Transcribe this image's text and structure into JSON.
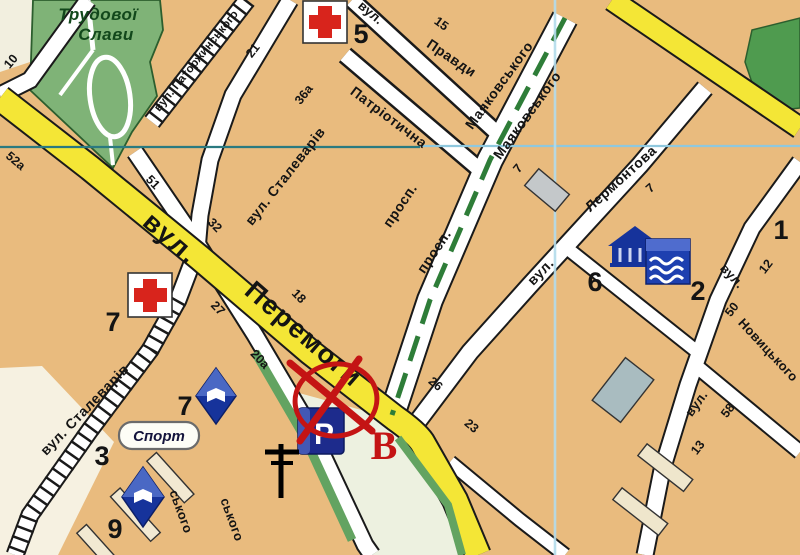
{
  "park": {
    "line1": "Трудової",
    "line2": "Слави"
  },
  "streets": {
    "peremohy_prefix": "вул.",
    "peremohy": "Перемоги",
    "stalevariv_upper": "вул. Сталеварів",
    "stalevariv_lower": "вул. Сталеварів",
    "patorzhynskoho": "вул. Паторжинського",
    "patriotychna": "Патріотична",
    "pravdy_prefix": "вул.",
    "pravdy": "Правди",
    "prospect_a": "просп.",
    "mayakovskoho_a": "Маяковського",
    "prospect_b": "просп.",
    "mayakovskoho_b": "Маяковського",
    "lermontova_prefix": "вул.",
    "lermontova": "Лермонтова",
    "novytskoho_prefix": "вул.",
    "novytskoho": "Новицького",
    "right_street_prefix": "вул.",
    "skoho_a": "ського",
    "skoho_b": "ського"
  },
  "house_numbers": {
    "n10": "10",
    "n52a": "52а",
    "n51": "51",
    "n21": "21",
    "n36a": "36а",
    "n32": "32",
    "n27": "27",
    "n18": "18",
    "n20a": "20а",
    "n15": "15",
    "n7_lerm_a": "7",
    "n7_lerm_b": "7",
    "n12": "12",
    "n50": "50",
    "n58": "58",
    "n13": "13",
    "n26": "26",
    "n23": "23"
  },
  "poi_numbers": {
    "n5": "5",
    "n7_left": "7",
    "n6": "6",
    "n2": "2",
    "n1": "1",
    "n3": "3",
    "n7_sport": "7",
    "n9": "9"
  },
  "poi": {
    "sport": "Спорт",
    "parking_letter": "P",
    "marker_letter": "В"
  },
  "colors": {
    "block_tan": "#e9bb7e",
    "cream": "#f3eedd",
    "park_green": "#7fb377",
    "strip_green": "#63a361",
    "road_yellow": "#f4e636",
    "grid_teal": "#2a7a80",
    "grid_blue": "#a9d8ea",
    "icon_blue": "#1b339b",
    "cross_red": "#d8241c",
    "marker_red": "#c41414"
  }
}
